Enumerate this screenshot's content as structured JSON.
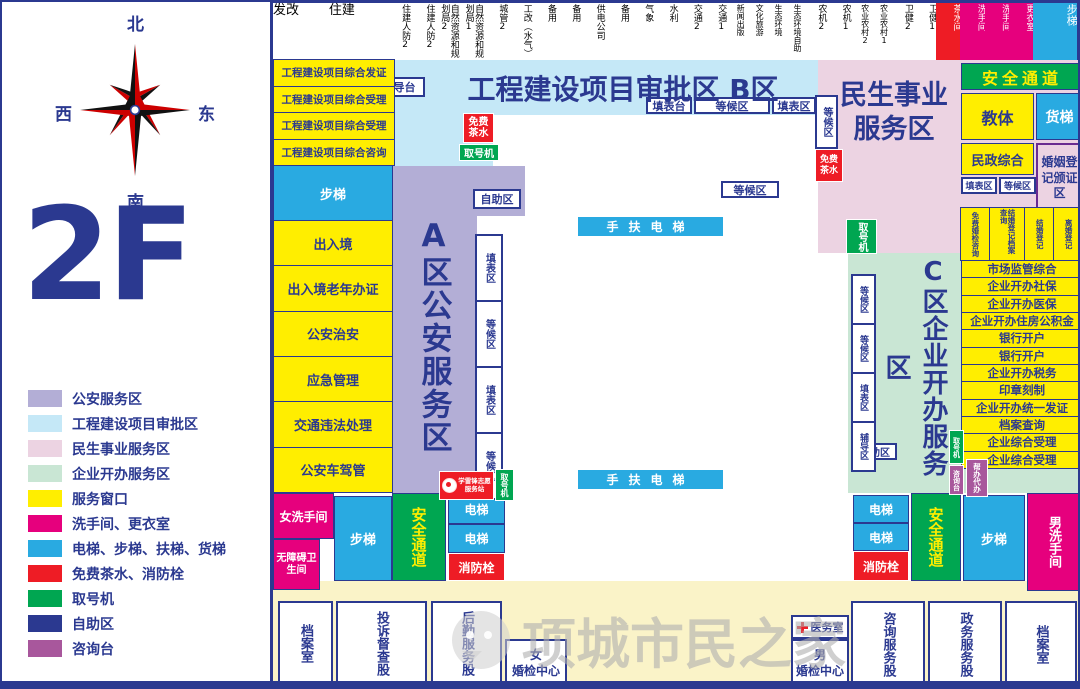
{
  "floor_label": "2F",
  "compass": {
    "north": "北",
    "south": "南",
    "west": "西",
    "east": "东"
  },
  "legend": [
    {
      "label": "公安服务区",
      "color": "#b3aed6"
    },
    {
      "label": "工程建设项目审批区",
      "color": "#c5e8f7"
    },
    {
      "label": "民生事业服务区",
      "color": "#ecd3e2"
    },
    {
      "label": "企业开办服务区",
      "color": "#c9e6d4"
    },
    {
      "label": "服务窗口",
      "color": "#ffee00"
    },
    {
      "label": "洗手间、更衣室",
      "color": "#e6007d"
    },
    {
      "label": "电梯、步梯、扶梯、货梯",
      "color": "#29aae1"
    },
    {
      "label": "免费茶水、消防栓",
      "color": "#ee1c25"
    },
    {
      "label": "取号机",
      "color": "#00a651"
    },
    {
      "label": "自助区",
      "color": "#2b3990"
    },
    {
      "label": "咨询台",
      "color": "#a8579c"
    }
  ],
  "top_row": [
    {
      "label": "发改",
      "cls": "wide"
    },
    {
      "label": "住建",
      "cls": "wide"
    },
    {
      "label": "住建人防2"
    },
    {
      "label": "住建人防2"
    },
    {
      "label": "自然资源和规划局2"
    },
    {
      "label": "自然资源和规划局1"
    },
    {
      "label": "城管2"
    },
    {
      "label": "工改（水气）"
    },
    {
      "label": "备用"
    },
    {
      "label": "备用"
    },
    {
      "label": "供电公司"
    },
    {
      "label": "备用"
    },
    {
      "label": "气象"
    },
    {
      "label": "水利"
    },
    {
      "label": "交通2"
    },
    {
      "label": "交通1"
    },
    {
      "label": "新闻出版",
      "cls": "sm"
    },
    {
      "label": "文化旅游",
      "cls": "sm"
    },
    {
      "label": "生态环境",
      "cls": "sm"
    },
    {
      "label": "生态环境自助",
      "cls": "sm"
    },
    {
      "label": "农机2"
    },
    {
      "label": "农机1"
    },
    {
      "label": "农业农村2",
      "cls": "sm"
    },
    {
      "label": "农业农村1",
      "cls": "sm"
    },
    {
      "label": "卫健2"
    },
    {
      "label": "卫健1"
    },
    {
      "label": "茶水间",
      "type": "tea"
    },
    {
      "label": "洗手间",
      "type": "wc"
    },
    {
      "label": "洗手间",
      "type": "wc"
    },
    {
      "label": "更衣室",
      "type": "wc"
    },
    {
      "label": "步梯",
      "type": "stairs",
      "cls": "stairs-top"
    }
  ],
  "b_area": {
    "title": "工程建设项目审批区  B区",
    "coach_desk": "辅导台",
    "cells": [
      "工程建设项目综合发证",
      "工程建设项目综合受理",
      "工程建设项目综合受理",
      "工程建设项目综合咨询"
    ],
    "form_desk": "填表台",
    "waiting_area": "等候区",
    "form_area": "填表区",
    "free_tea": "免费茶水",
    "ticket": "取号机",
    "waiting_side": "等候区",
    "free_tea_side": "免费茶水"
  },
  "minsheng_area": {
    "title": "民生事业服务区",
    "ticket": "取号机",
    "waiting": "等候区"
  },
  "a_area": {
    "title": "A区公安服务区",
    "self_area": "自助区",
    "stack": [
      "填表区",
      "等候区",
      "填表区",
      "等候区"
    ],
    "volunteer": "学雷锋志愿服务站",
    "ticket": "取号机"
  },
  "c_area": {
    "title": "C区企业开办服务区",
    "stack": [
      "等候区",
      "等候区",
      "填表区",
      "辅导区"
    ],
    "self_area": "自助区",
    "ticket": "取号机"
  },
  "left_column": [
    {
      "label": "步梯",
      "type": "stairs"
    },
    {
      "label": "出入境"
    },
    {
      "label": "出入境老年办证"
    },
    {
      "label": "公安治安"
    },
    {
      "label": "应急管理"
    },
    {
      "label": "交通违法处理"
    },
    {
      "label": "公安车驾管"
    }
  ],
  "right_column": {
    "safe_passage": "安全通道",
    "edu": "教体",
    "freight": "货梯",
    "civil": "民政综合",
    "marriage_hall": "婚姻登记颁证区",
    "form": "填表区",
    "waiting": "等候区",
    "marriage_cells": [
      {
        "label": "免费婚检咨询"
      },
      {
        "label": "结婚登记档案查询",
        "cls": "wide2"
      },
      {
        "label": "结婚登记"
      },
      {
        "label": "离婚登记"
      }
    ],
    "services": [
      "市场监管综合",
      "企业开办社保",
      "企业开办医保",
      "企业开办住房公积金",
      "银行开户",
      "银行开户",
      "企业开办税务",
      "印章刻制",
      "企业开办统一发证",
      "档案查询",
      "企业综合受理",
      "企业综合受理"
    ],
    "ticket": "取号机",
    "consult": "咨询台",
    "assist": "帮办代办"
  },
  "escalator": "手扶电梯",
  "fixtures": {
    "women_wc": "女洗手间",
    "accessible_wc": "无障碍卫生间",
    "stairs_left": "步梯",
    "safe_left": "安全通道",
    "elevator_1": "电梯",
    "elevator_2": "电梯",
    "fire_left": "消防栓",
    "elevator_3": "电梯",
    "elevator_4": "电梯",
    "fire_right": "消防栓",
    "safe_right": "安全通道",
    "stairs_right": "步梯",
    "men_wc": "男洗手间"
  },
  "bottom_rooms": {
    "archive_left": "档案室",
    "complaint": "投诉督查股",
    "logistics": "后勤服务股",
    "women_l1": "女",
    "premarital": "婚检中心",
    "clinic": "医务室",
    "men_l1": "男",
    "consult": "咨询服务股",
    "government": "政务服务股",
    "archive_right": "档案室"
  },
  "watermark": {
    "text": "项城市民之家"
  }
}
